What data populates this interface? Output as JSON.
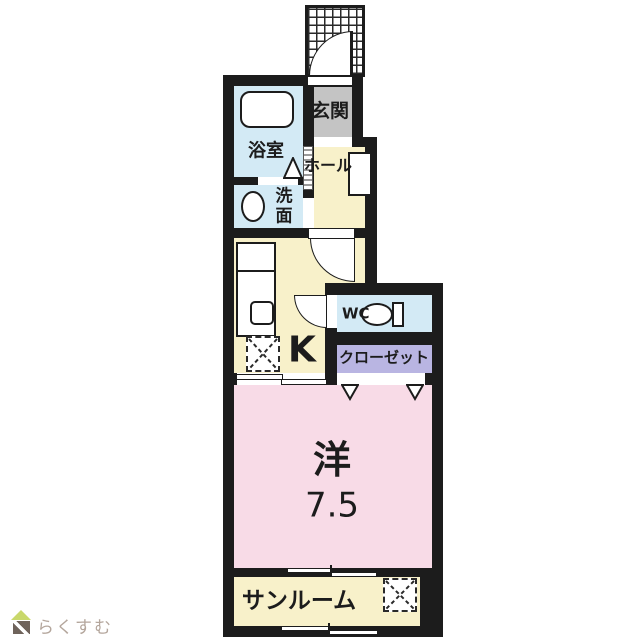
{
  "floor_plan": {
    "rooms": [
      {
        "id": "entrance",
        "label": "玄関",
        "color": "#c4c4c4"
      },
      {
        "id": "bathroom",
        "label": "浴室",
        "color": "#d3eaf5"
      },
      {
        "id": "washroom",
        "label": "洗面",
        "color": "#d3eaf5"
      },
      {
        "id": "hall",
        "label": "ホール",
        "color": "#f8f1ca"
      },
      {
        "id": "kitchen",
        "label": "K",
        "color": "#f8f1ca"
      },
      {
        "id": "toilet",
        "label": "WC",
        "color": "#d3eaf5"
      },
      {
        "id": "closet",
        "label": "クローゼット",
        "color": "#b9b5e2"
      },
      {
        "id": "western-room",
        "label": "洋",
        "size": "7.5",
        "color": "#f8dbe7"
      },
      {
        "id": "sunroom",
        "label": "サンルーム",
        "color": "#f8f1ca"
      }
    ],
    "fixtures": [
      "entrance-porch",
      "entrance-door-swing",
      "bathtub",
      "washbasin",
      "washing-machine-space",
      "kitchen-counter",
      "stove",
      "refrigerator-space",
      "toilet-bowl",
      "door-swing",
      "folding-door",
      "sliding-door",
      "closet-bifold-door",
      "sunroom-storage-space"
    ],
    "colors": {
      "wall": "#1c1c1c",
      "water_area": "#d3eaf5",
      "entrance": "#c4c4c4",
      "wood_floor": "#f8f1ca",
      "closet": "#b9b5e2",
      "bedroom": "#f8dbe7",
      "background": "#ffffff"
    }
  },
  "branding": {
    "logo_text": "らくすむ",
    "logo_roof_color": "#c9d86b",
    "logo_body_color": "#6f635b",
    "logo_text_color": "#b4a69c"
  }
}
